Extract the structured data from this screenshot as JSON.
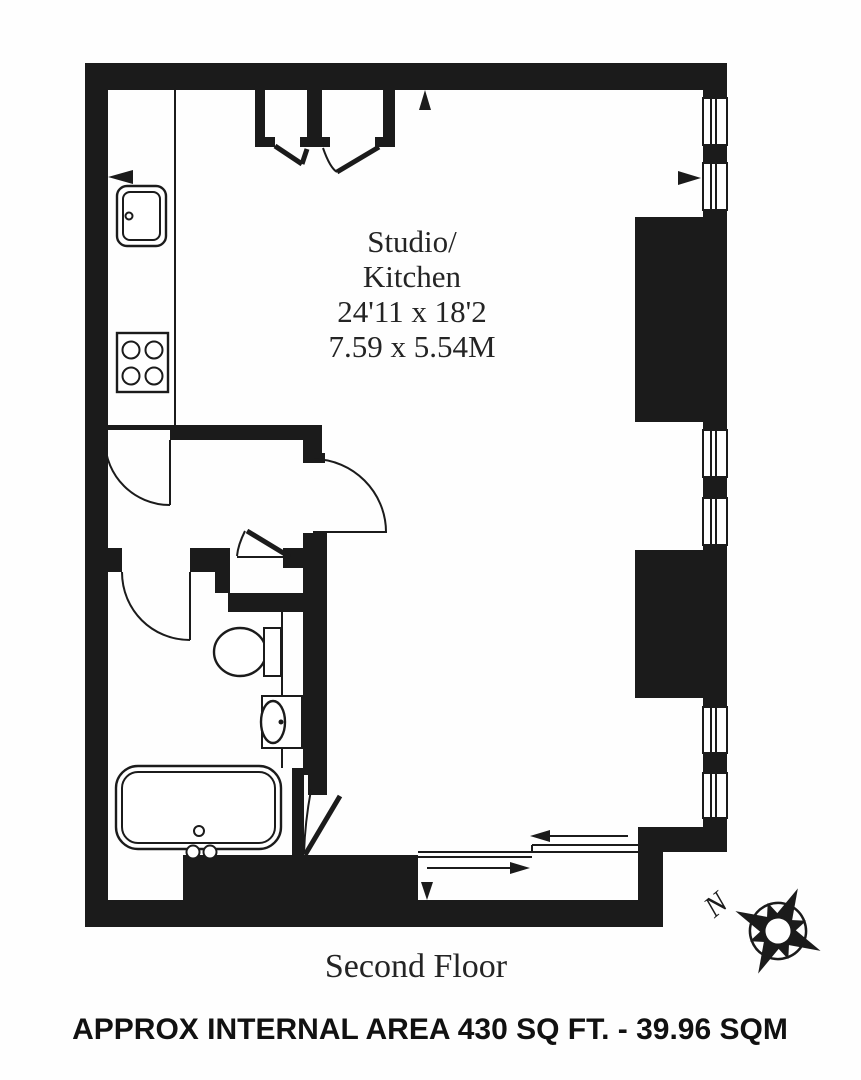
{
  "floorplan": {
    "room": {
      "label_line1": "Studio/",
      "label_line2": "Kitchen",
      "dimensions_imperial": "24'11 x 18'2",
      "dimensions_metric": "7.59 x 5.54M"
    },
    "floor_label": "Second Floor",
    "area_caption": "APPROX INTERNAL AREA 430 SQ FT. - 39.96 SQM",
    "compass": {
      "north_label": "N"
    },
    "colors": {
      "wall_ink": "#1b1b1b",
      "background": "#fefefe",
      "text": "#242424"
    }
  }
}
